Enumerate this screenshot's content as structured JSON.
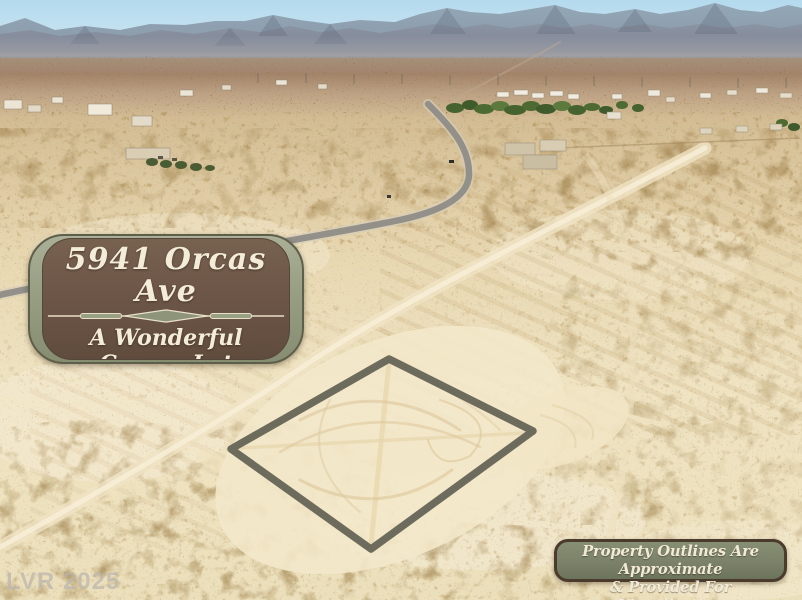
{
  "address_sign": {
    "address": "5941 Orcas Ave",
    "description_line1": "A Wonderful Corner Lot",
    "description_line2": "With Water & Sewer",
    "description_line3": "At The Property Line"
  },
  "disclaimer_sign": {
    "line1": "Property Outlines Are Approximate",
    "line2": "& Provided For Visualization"
  },
  "photo": {
    "watermark": "LVR 2025"
  },
  "colors": {
    "sign_brown": "#6d5648",
    "sign_sage_border": "#9aa083",
    "sign_text_cream": "#f3ecd8",
    "disclaimer_green": "#7b8269",
    "disclaimer_border": "#4a3b2d",
    "property_outline_gray": "#646456",
    "sky_blue": "#bcdeee",
    "desert_tan": "#e8d8b2"
  }
}
